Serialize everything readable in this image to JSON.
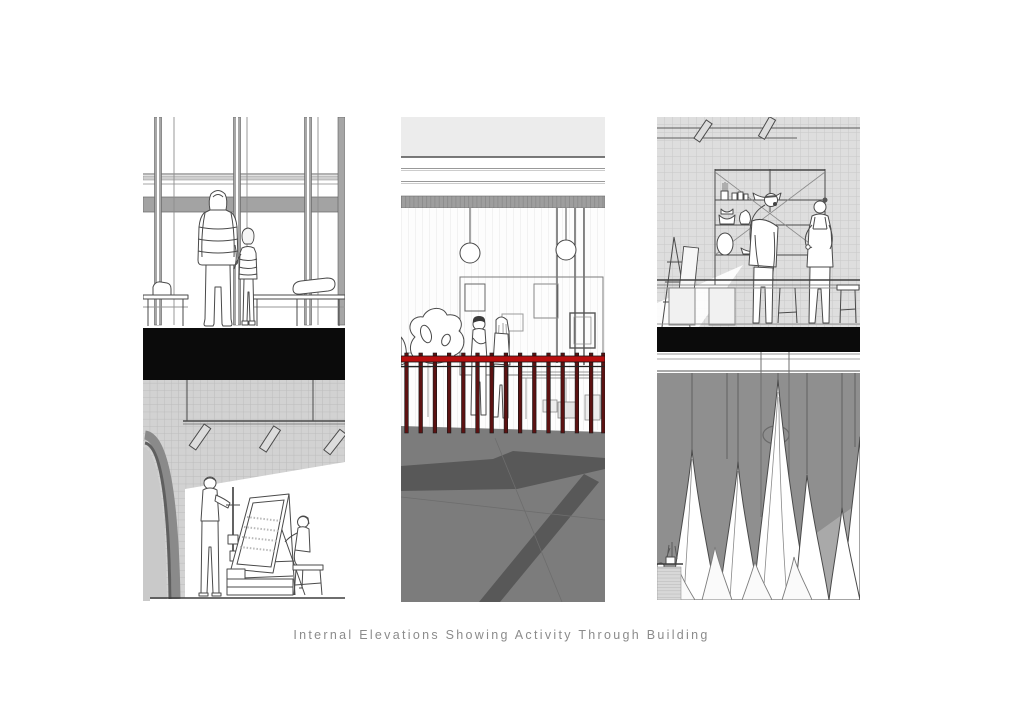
{
  "page": {
    "background": "#ffffff"
  },
  "caption": {
    "text": "Internal Elevations Showing Activity Through Building"
  },
  "palette": {
    "paper": "#ffffff",
    "ink": "#4a4a4a",
    "black-slab": "#0b0b0b",
    "tile": "#d2d2d2",
    "tile-line": "#bcbcbc",
    "tile-light": "#dedede",
    "tile-light-line": "#c8c8c8",
    "band-gray": "#a3a3a3",
    "top-band": "#ececec",
    "hatch-gray": "#9e9e9e",
    "ground-gray": "#7c7c7c",
    "ground-dark": "#585858",
    "lower-gray": "#8f8f8f",
    "lower-light": "#a9a9a9",
    "rail-red": "#b80f0f",
    "rail-post": "#5c1212",
    "caption-gray": "#8b8b8b"
  }
}
